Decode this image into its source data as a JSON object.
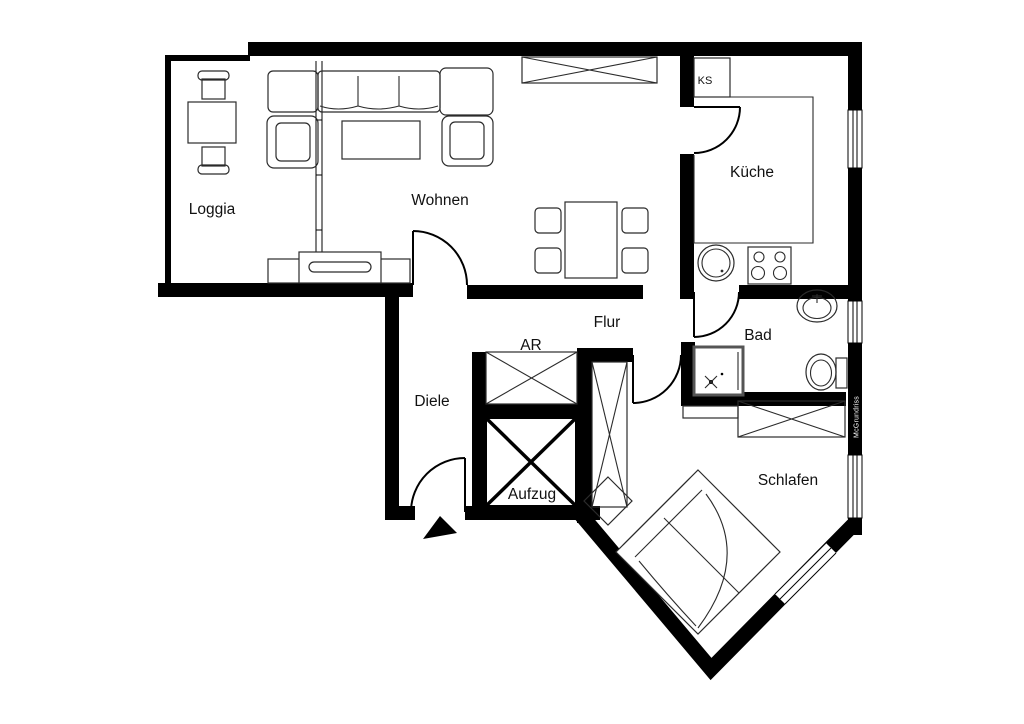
{
  "plan": {
    "type": "apartment-floorplan",
    "rooms": {
      "loggia": "Loggia",
      "wohnen": "Wohnen",
      "kueche": "Küche",
      "flur": "Flur",
      "diele": "Diele",
      "bad": "Bad",
      "schlafen": "Schlafen",
      "aufzug": "Aufzug",
      "ar": "AR",
      "ks": "KS"
    },
    "watermark": "McGrundriss",
    "colors": {
      "wall": "#000000",
      "furniture_line": "#2b2b2b",
      "background": "#ffffff"
    }
  }
}
